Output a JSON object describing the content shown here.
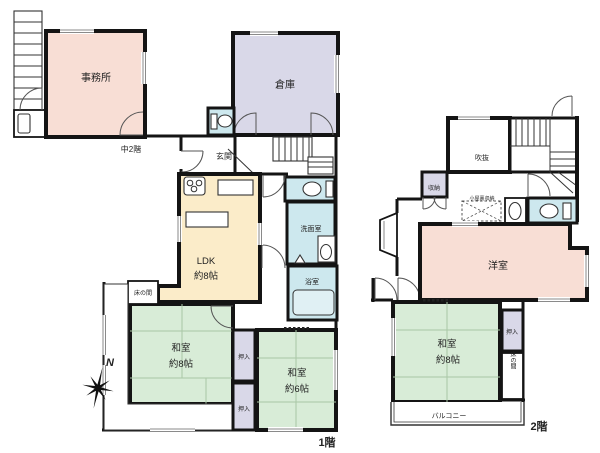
{
  "palette": {
    "wall": "#141414",
    "room_pink": "#f8ded5",
    "room_purple": "#d9d8e8",
    "room_yellow": "#fbecc9",
    "room_green": "#d8ecd7",
    "room_blue": "#cde8ee",
    "tatami_line": "#a9c6a5",
    "background": "#ffffff"
  },
  "compass": {
    "north": "N"
  },
  "floor1": {
    "floor_label": "1階",
    "mezzanine_label": "中2階",
    "office": "事務所",
    "warehouse": "倉庫",
    "entrance": "玄関",
    "ldk": {
      "name": "LDK",
      "size": "約8帖"
    },
    "washroom": "洗面室",
    "bathroom": "浴室",
    "tatami8": {
      "name": "和室",
      "size": "約8帖"
    },
    "tatami6": {
      "name": "和室",
      "size": "約6帖"
    },
    "tokonoma": "床の間",
    "closet_upper": "押入",
    "closet_lower": "押入"
  },
  "floor2": {
    "floor_label": "2階",
    "void": "吹抜",
    "storage": "収納",
    "attic_storage": "小屋裏収納",
    "western_room": "洋室",
    "tatami8": {
      "name": "和室",
      "size": "約8帖"
    },
    "closet": "押入",
    "tokonoma": "床の間",
    "balcony": "バルコニー"
  }
}
